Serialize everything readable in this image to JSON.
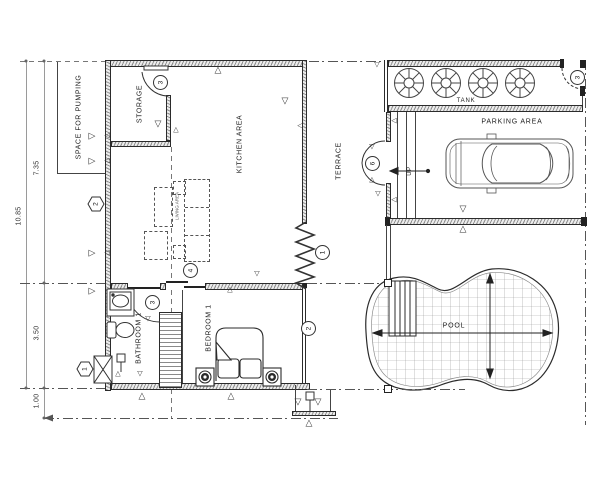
{
  "title": "House Ground Floor Plan",
  "rooms": {
    "space_for_pumping": "SPACE FOR PUMPING",
    "storage": "STORAGE",
    "kitchen": "KITCHEN AREA",
    "living": "LIVING AREA",
    "terrace": "TERRACE",
    "bathroom": "BATHROOM 1",
    "bedroom": "BEDROOM 1",
    "tank": "TANK",
    "parking": "PARKING AREA",
    "pool": "POOL",
    "up": "UP"
  },
  "dims": {
    "total": "10.85",
    "upper": "7.35",
    "lower": "3.50",
    "offset": "1.00"
  },
  "callouts": {
    "c1": "1",
    "c2": "2",
    "c3": "3",
    "c4": "4",
    "c6": "6"
  },
  "icons": {
    "tri_down": "▽",
    "tri_up": "△",
    "tri_left": "◁",
    "tri_right": "▷"
  },
  "colors": {
    "line": "#2b2b2b",
    "dim_line": "#9a9a9a",
    "hatch": "#8f8f8f",
    "grid": "#999999"
  }
}
